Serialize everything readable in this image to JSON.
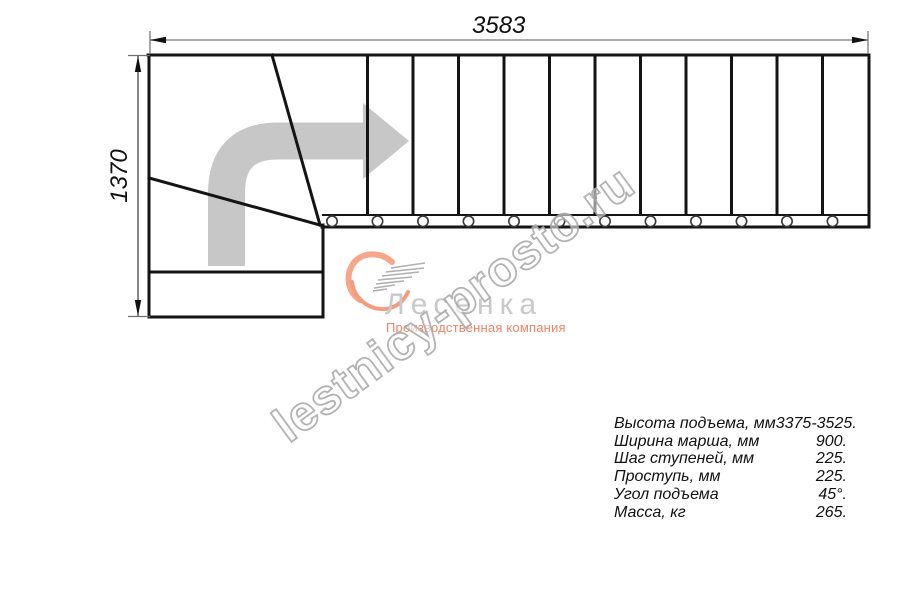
{
  "drawing": {
    "type": "staircase-plan-top-view",
    "straight_treads": 12,
    "winder_section": true,
    "balusters": 12,
    "direction": "up-then-right"
  },
  "dimensions": {
    "width_mm": "3583",
    "height_mm": "1370"
  },
  "logo": {
    "name": "Лесенка",
    "tagline": "Производственная компания",
    "accent_color": "#f59d80",
    "text_color": "#c9c9c9"
  },
  "watermark": {
    "text": "lestnicy-prosto.ru"
  },
  "specs": {
    "rows": [
      {
        "label": "Высота подъема, мм",
        "value": "3375-3525."
      },
      {
        "label": "Ширина марша, мм",
        "value": "900."
      },
      {
        "label": "Шаг ступеней, мм",
        "value": "225."
      },
      {
        "label": "Проступь, мм",
        "value": "225."
      },
      {
        "label": "Угол подъема",
        "value": "45°."
      },
      {
        "label": "Масса, кг",
        "value": "265."
      }
    ]
  }
}
